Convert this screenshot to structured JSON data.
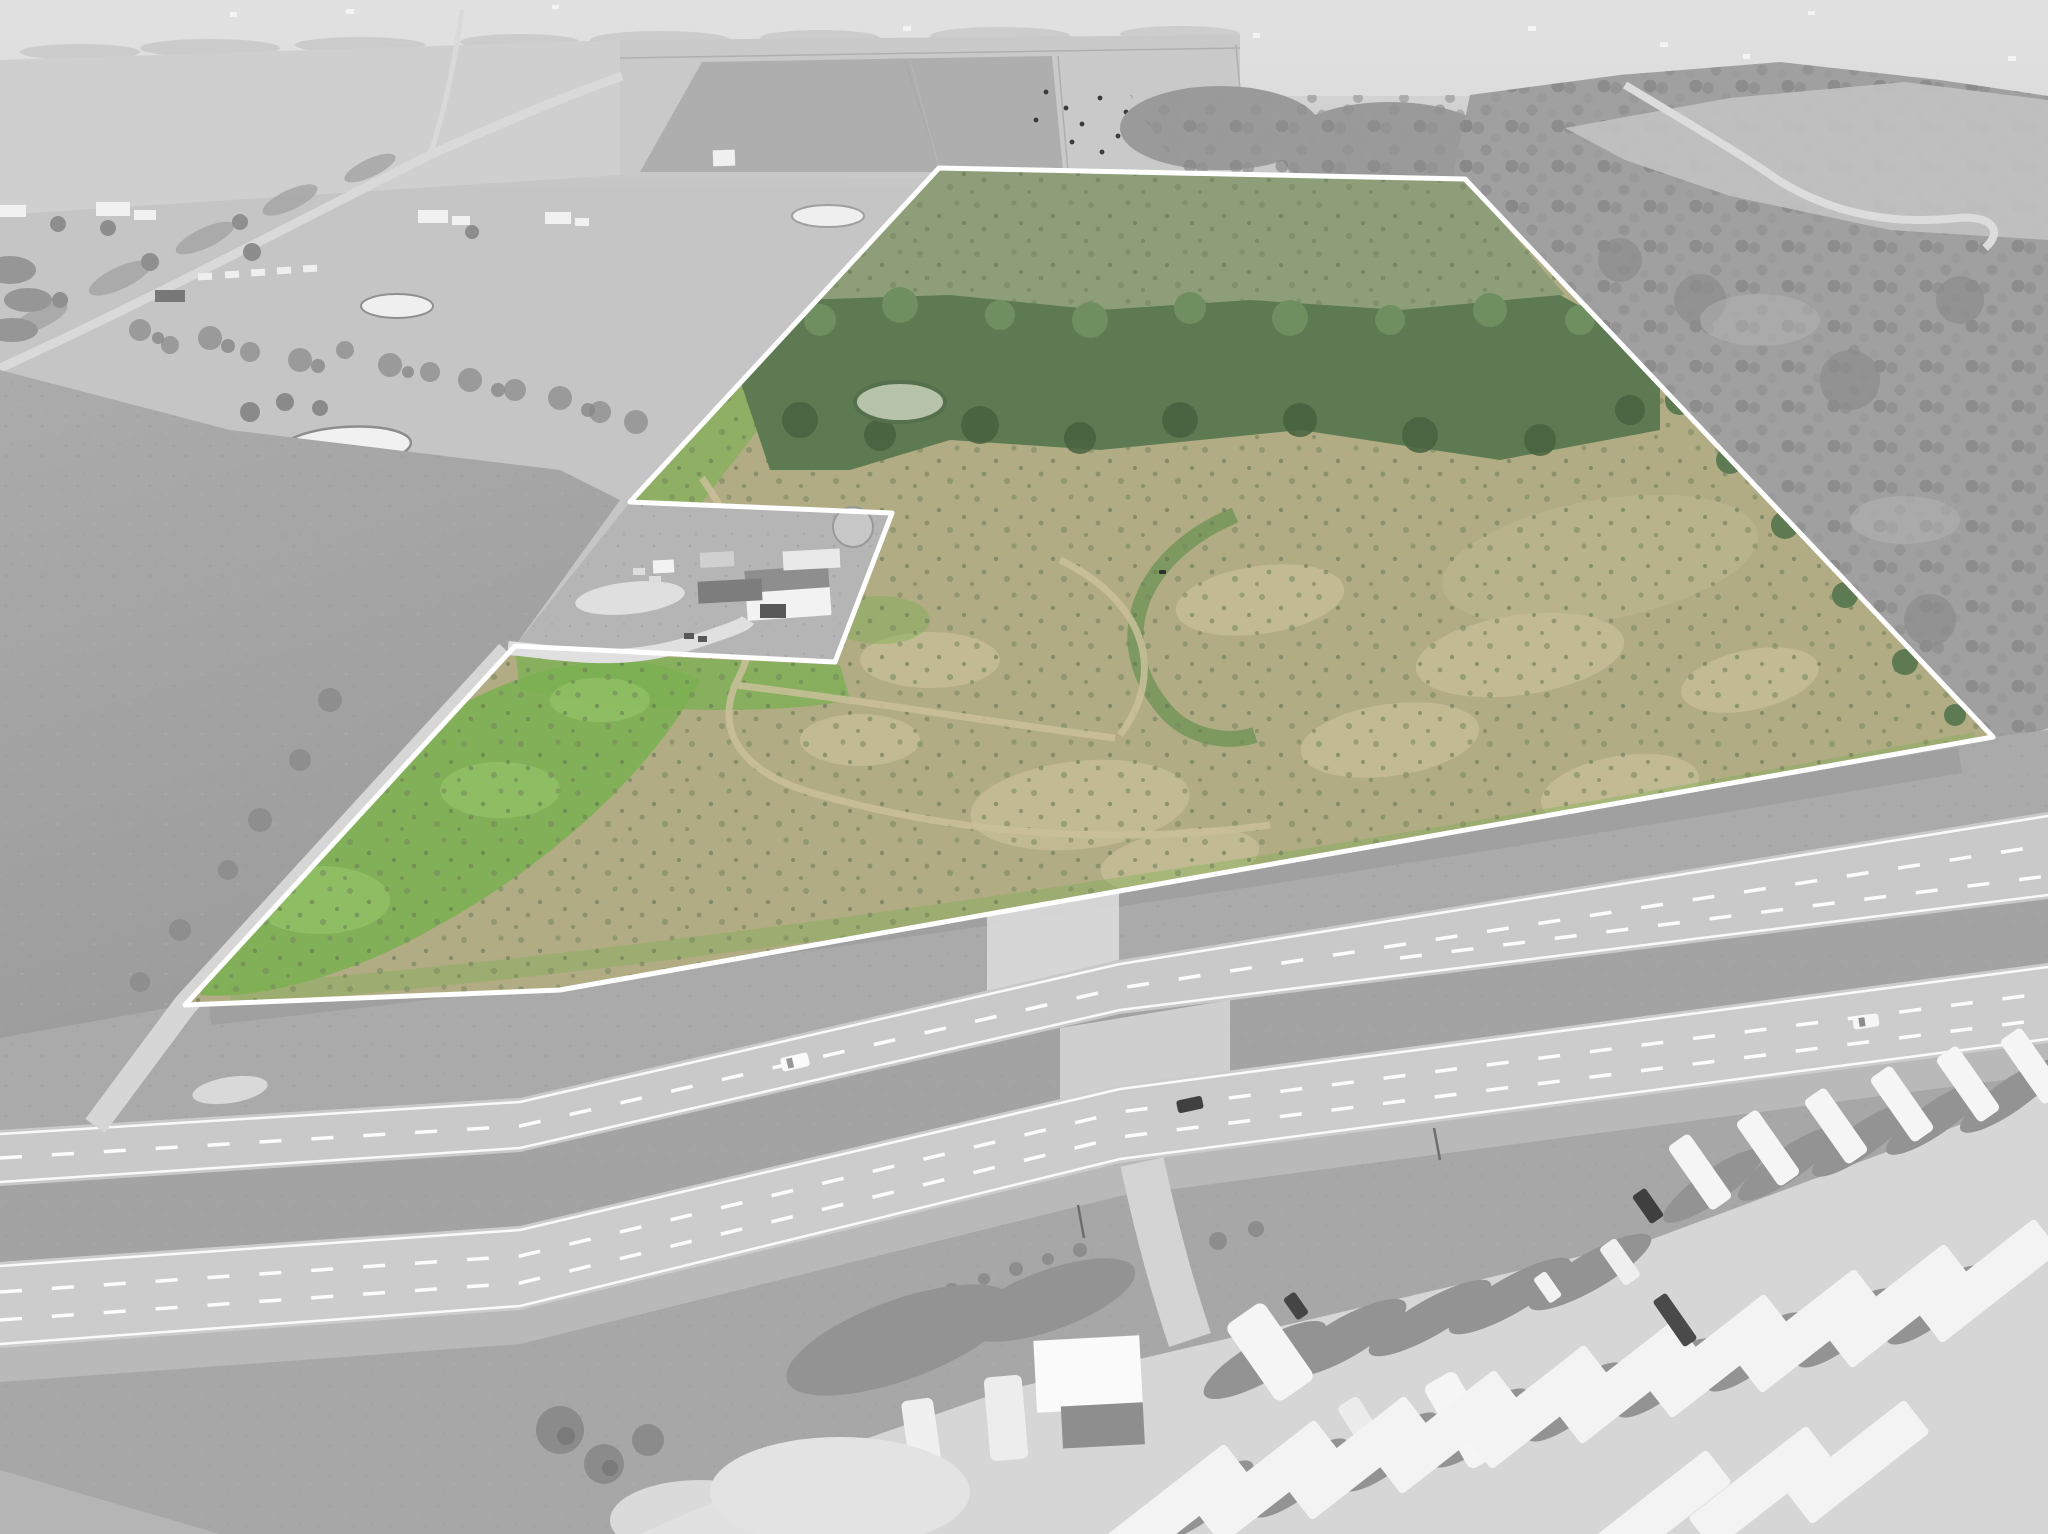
{
  "scene": {
    "type": "aerial-drone-photograph",
    "subject": "rural land parcel highlighted in green over a grayscale countryside, bounded by a divided highway, with a farmstead excluded from the boundary and an RV park across the highway",
    "canvas": {
      "width": 2048,
      "height": 1534
    }
  },
  "overlay": {
    "parcel_path": "M939,168 L1465,179 L1993,737 L1040,905 L560,990 L185,1005 L515,646 L835,662 L892,513 L630,502 Z",
    "excluded_farmstead_path": "M515,646 L835,662 L892,513 L630,502 Z",
    "boundary_color": "#ffffff",
    "boundary_width": 5
  },
  "colors": {
    "canvas_bg": "#c5c5c5",
    "haze": "#d8d8d8",
    "field_light": "#cfcfcf",
    "field_mid": "#bdbdbd",
    "field_dark": "#aeaeae",
    "plow_dark": "#a4a4a4",
    "tree_gray": "#9a9a9a",
    "tree_gray_dark": "#878787",
    "forest": "#a0a0a0",
    "road_light": "#d9d9d9",
    "pond_gray": "#efefef",
    "water_rim": "#8d8d8d",
    "pavement": "#c9c9c9",
    "pavement2": "#cccccc",
    "median": "#a3a3a3",
    "ditch": "#aaaaaa",
    "shoulder": "#b9b9b9",
    "verge": "#a7a7a7",
    "gravel": "#d6d6d6",
    "wash_white": "#e3e3e3",
    "lane_white": "#ffffff",
    "rv_white": "#f5f5f5",
    "home_white": "#f3f3f3",
    "vehicle_dark": "#404040",
    "pasture": "#b2ac85",
    "meadow": "#8d9e79",
    "tree_belt": "#5d7a52",
    "tree_belt_dark": "#47613f",
    "tree_belt_light": "#6f8f60",
    "bright_green": "#7cb053",
    "bright_green_light": "#98c66b",
    "parcel_pond": "#b6c3a8",
    "pond_rim_green": "#54704c",
    "tan": "#c6bd96",
    "trail": "#c9c09a",
    "shrub": "#76865e",
    "farmstead": "#b5b5b5",
    "building_white": "#f2f2f2",
    "roof_gray": "#8e8e8e",
    "shed_dark": "#7d7d7d"
  },
  "features": {
    "highway": {
      "roadways": 2,
      "median": true,
      "median_crossover": true,
      "entrance_apron": true
    },
    "vehicles_on_highway": 3,
    "ponds_outside_parcel": 3,
    "ponds_inside_parcel": 1,
    "rv_park": {
      "upper_row_rvs": 6,
      "mobile_home_row": 10,
      "second_row": 3
    }
  }
}
